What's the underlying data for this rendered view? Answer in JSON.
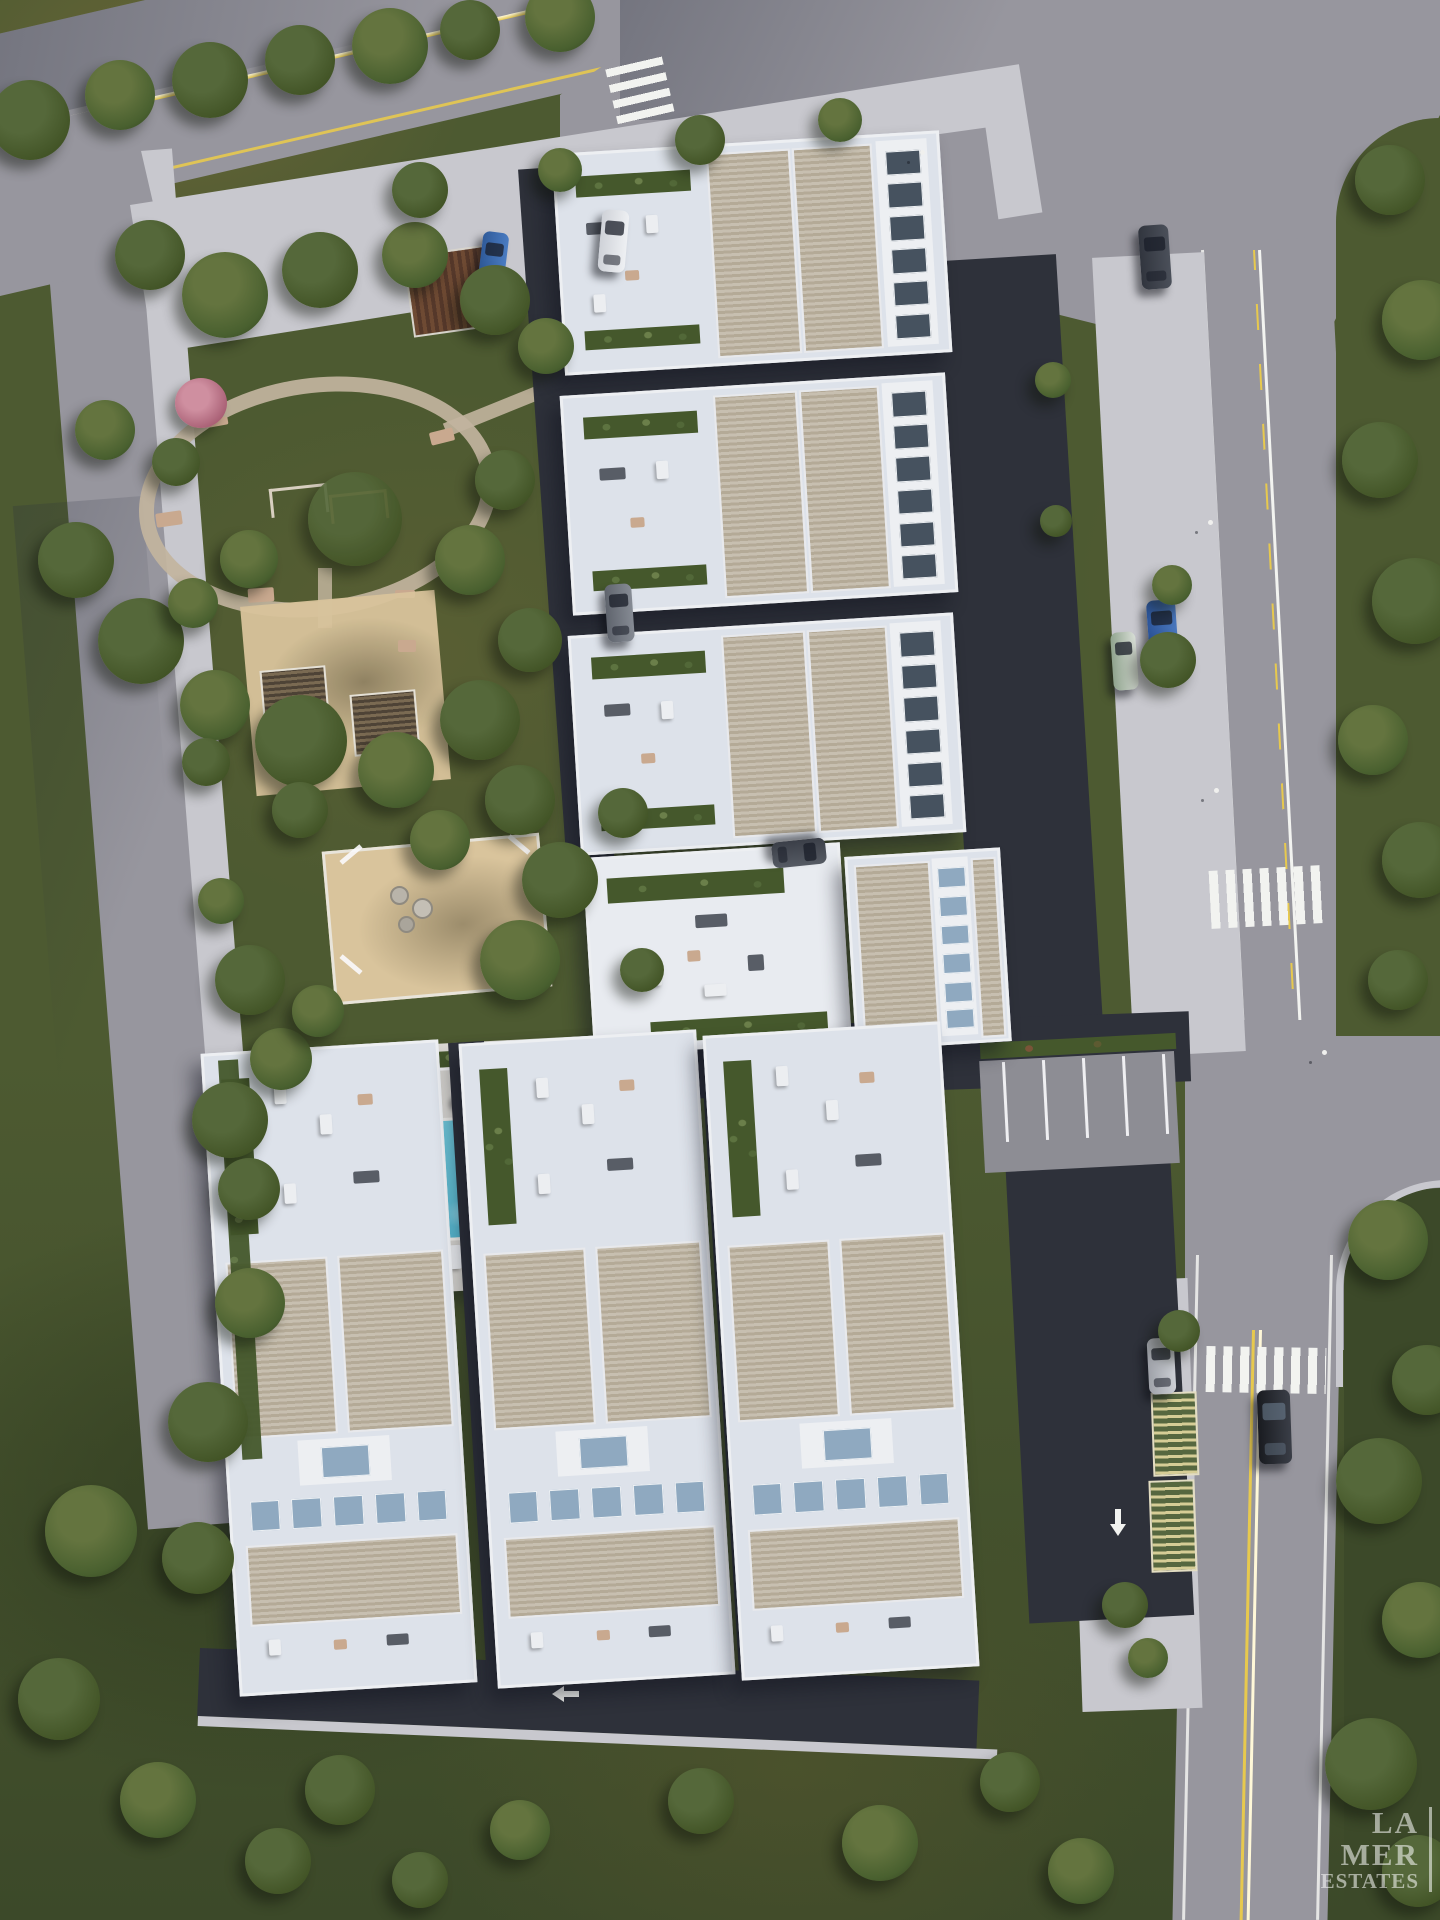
{
  "watermark": {
    "line1": "LA",
    "line2": "MER",
    "line3": "ESTATES"
  },
  "palette": {
    "grass": "#4d5a31",
    "grass-dark": "#3c4929",
    "grass-warm": "#6e6638",
    "road": "#97969e",
    "road-dark": "#74747e",
    "sidewalk": "#c8c8ce",
    "asphalt": "#2e313a",
    "building": "#edeff2",
    "terrace": "#dde2ea",
    "rib-a": "#b4aa97",
    "rib-b": "#c7bfb0",
    "pool-a": "#7ed2e2",
    "pool-b": "#3da8c6",
    "deck": "#d2d0cb",
    "sand": "#d9c49c",
    "planter": "#45582c",
    "tree-a": "#425426",
    "tree-b": "#55683a",
    "yellow": "#e7c94e",
    "line-white": "#f2f3f0",
    "skylight": "#8fa9c0",
    "watermark": "rgba(255,255,255,0.55)"
  },
  "scene": {
    "type": "aerial-architectural-render",
    "description": "Top-down 3D visualization of a residential complex with six apartment blocks, communal park with playground and pergolas, swimming pool with sun deck, amenity roof terrace, guest parking and perimeter streets",
    "apartment_blocks_right_column": 3,
    "apartment_blocks_bottom_row": 3,
    "amenities": [
      "landscaped park",
      "oval walking path",
      "swing playground",
      "pergola lounge",
      "sand playground",
      "swimming pool",
      "pool deck with loungers",
      "amenity roof terrace",
      "guest parking",
      "covered carport"
    ],
    "cars": [
      {
        "color": "blue",
        "location": "top parking court"
      },
      {
        "color": "white",
        "location": "top parking court"
      },
      {
        "color": "dark-gray",
        "location": "east street parking, north"
      },
      {
        "color": "gray",
        "location": "internal drive between blocks"
      },
      {
        "color": "dark-gray",
        "location": "internal drive south of third block"
      },
      {
        "color": "blue",
        "location": "east street parking, middle"
      },
      {
        "color": "green-white",
        "location": "east sidewalk bay"
      },
      {
        "color": "silver",
        "location": "south-east parking bay"
      },
      {
        "color": "black",
        "location": "driving on south-east road"
      }
    ],
    "road_markings": [
      "double yellow center lines",
      "white edge lines",
      "zebra crosswalk on north road",
      "zebra crosswalk on east road upper",
      "zebra crosswalk on east road lower",
      "white lane arrows",
      "parking stall lines"
    ]
  }
}
